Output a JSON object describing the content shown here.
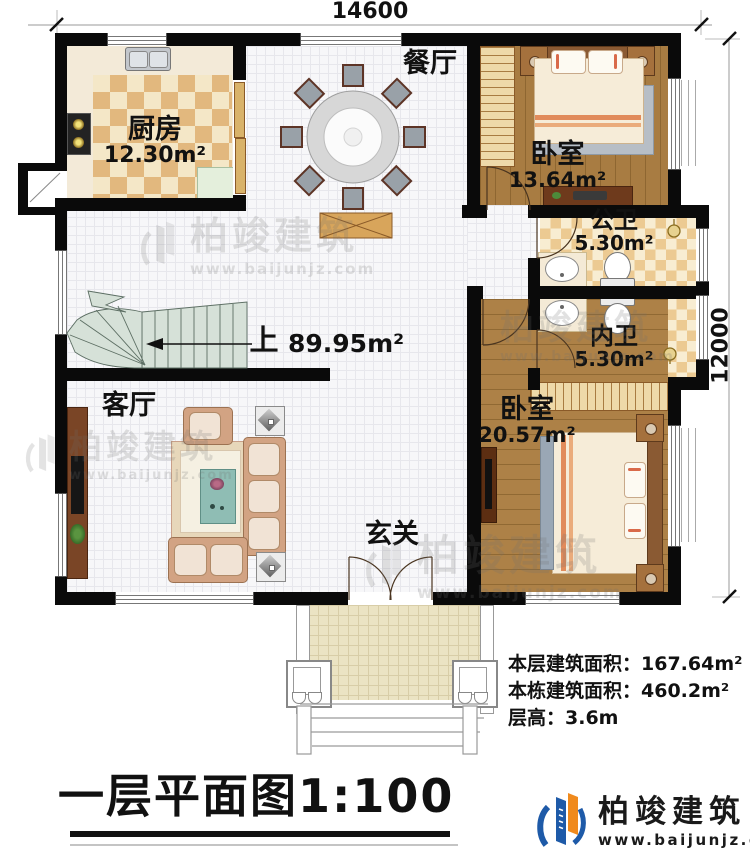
{
  "dimensions": {
    "top": "14600",
    "right": "12000"
  },
  "rooms": {
    "kitchen": {
      "name": "厨房",
      "area": "12.30m²"
    },
    "dining": {
      "name": "餐厅"
    },
    "bedroom1": {
      "name": "卧室",
      "area": "13.64m²"
    },
    "public_bath": {
      "name": "公卫",
      "area": "5.30m²"
    },
    "private_bath": {
      "name": "内卫",
      "area": "5.30m²"
    },
    "bedroom2": {
      "name": "卧室",
      "area": "20.57m²"
    },
    "living": {
      "name": "客厅"
    },
    "foyer": {
      "name": "玄关"
    },
    "stairs": {
      "up_label": "上"
    },
    "open_area": {
      "area": "89.95m²"
    }
  },
  "info": {
    "line1": "本层建筑面积：167.64m²",
    "line2": "本栋建筑面积：460.2m²",
    "line3": "层高：3.6m"
  },
  "title": {
    "text": "一层平面图1:100"
  },
  "brand": {
    "name": "柏竣建筑",
    "url": "www.baijunjz.com"
  },
  "watermark": {
    "name": "柏竣建筑",
    "url": "www.baijunjz.com"
  },
  "colors": {
    "wall": "#0a0a0a",
    "wood_floor": "#a87c42",
    "checker_tan": "#e2b87e",
    "checker_cream": "#f4e7c7",
    "stairs_fill": "#d6e1d8",
    "brand_blue": "#1e5aa8",
    "brand_orange": "#f08a1d"
  }
}
